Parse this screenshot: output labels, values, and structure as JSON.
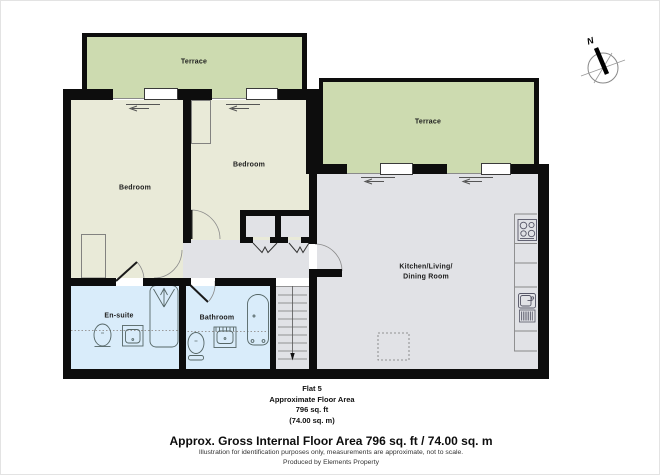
{
  "rooms": {
    "terrace1": "Terrace",
    "terrace2": "Terrace",
    "bedroom1": "Bedroom",
    "bedroom2": "Bedroom",
    "kitchen_line1": "Kitchen/Living/",
    "kitchen_line2": "Dining Room",
    "ensuite": "En-suite",
    "bathroom": "Bathroom"
  },
  "compass": {
    "north_label": "N"
  },
  "summary": {
    "line1": "Flat 5",
    "line2": "Approximate Floor Area",
    "line3": "796 sq. ft",
    "line4": "(74.00 sq. m)"
  },
  "footer": {
    "headline": "Approx. Gross Internal Floor Area 796 sq. ft / 74.00 sq. m",
    "disclaimer": "Illustration for identification purposes only, measurements are approximate, not to scale.",
    "credit": "Produced by Elements Property"
  },
  "colors": {
    "wall": "#0d0d0d",
    "terrace": "#cddbb0",
    "bedroom": "#e9ead8",
    "kitchen": "#e1e2e6",
    "bath": "#d9ecfa",
    "line": "#555555"
  }
}
